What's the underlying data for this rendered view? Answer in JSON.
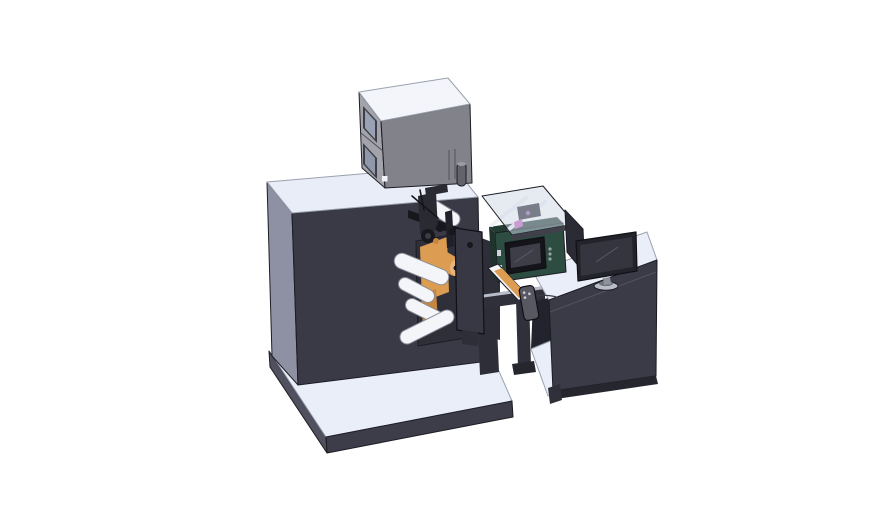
{
  "scene": {
    "description": "Isometric 3D CAD render of a digital label printing press with unwind rollers, HMI touchscreen, glass print-engine cover, output slide, pendant control and an operator desk with monitor",
    "background": "#ffffff"
  },
  "colors": {
    "machineFront": "#3a3a46",
    "machineLeft": "#8e90a4",
    "machineTop": "#e9edf8",
    "baseTop": "#e9eef8",
    "baseFront": "#3d3d49",
    "baseLeft": "#50505e",
    "boxFront": "#82828a",
    "boxLeft": "#a2a3ab",
    "boxTop": "#f3f5fa",
    "boxWindowFrame": "#3f3f47",
    "boxWindowPane": "#99a2b5",
    "boxWindowPane2": "#8f98ab",
    "boxSquare": "#f0f2f6",
    "cylinderBody": "#63636b",
    "cylinderTop": "#9b9ba3",
    "fillerDark": "#2e2e38",
    "beamDark": "#30303b",
    "beamLight": "#b9bdc9",
    "plateDark": "#383845",
    "plateBack": "#2f2f3a",
    "plateTab": "#2e2e38",
    "orange": "#dc9d52",
    "orangeDark": "#c9853d",
    "orangeEnd": "#e8b57a",
    "rollerFill": "#f3f5f9",
    "rollerStroke": "#8a8c96",
    "mechBlack": "#17171d",
    "mechGray": "#2a2a33",
    "mechGray2": "#3c3c45",
    "mechPost": "#20202a",
    "greenFront": "#2d4c42",
    "greenTop": "#223c34",
    "greenSide": "#1d332c",
    "screenBezel": "#14141a",
    "screenInner": "#3e3e48",
    "buttonDot": "#9aa39e",
    "clasp": "#cfd3da",
    "glassFill": "rgba(206,215,229,0.5)",
    "glassFrame": "#3f4049",
    "glassInternal": "#23232c",
    "magenta": "#c95fc2",
    "purple": "#8a5fae",
    "deskTop": "#eaeef8",
    "deskFront": "#3b3b47",
    "deskInterior": "#23232d",
    "deskBase": "#26262f",
    "deskLeg": "#30303b",
    "panelDark": "#2b2b35",
    "monitorBezel": "#23232b",
    "monitorScreen": "#35353f",
    "standStem": "#8f929c",
    "standBase": "#b9bdc8",
    "standDisc": "#6f727d",
    "pendant": "#585862",
    "pendantDot": "#cdd1da",
    "dotOnPanel": "#464653"
  },
  "components": [
    "base platform",
    "main machine cabinet",
    "top gray cabinet",
    "cabinet window upper",
    "cabinet window lower",
    "signal cylinder",
    "web guide rollers",
    "label web",
    "supply roll",
    "print head assembly",
    "front mounting plate",
    "glass inspection cover",
    "print engine internals",
    "hmi enclosure",
    "hmi touchscreen",
    "output slide",
    "support frame",
    "pendant control",
    "operator desk",
    "desk shelf",
    "monitor side panel",
    "desk monitor",
    "monitor stand"
  ]
}
